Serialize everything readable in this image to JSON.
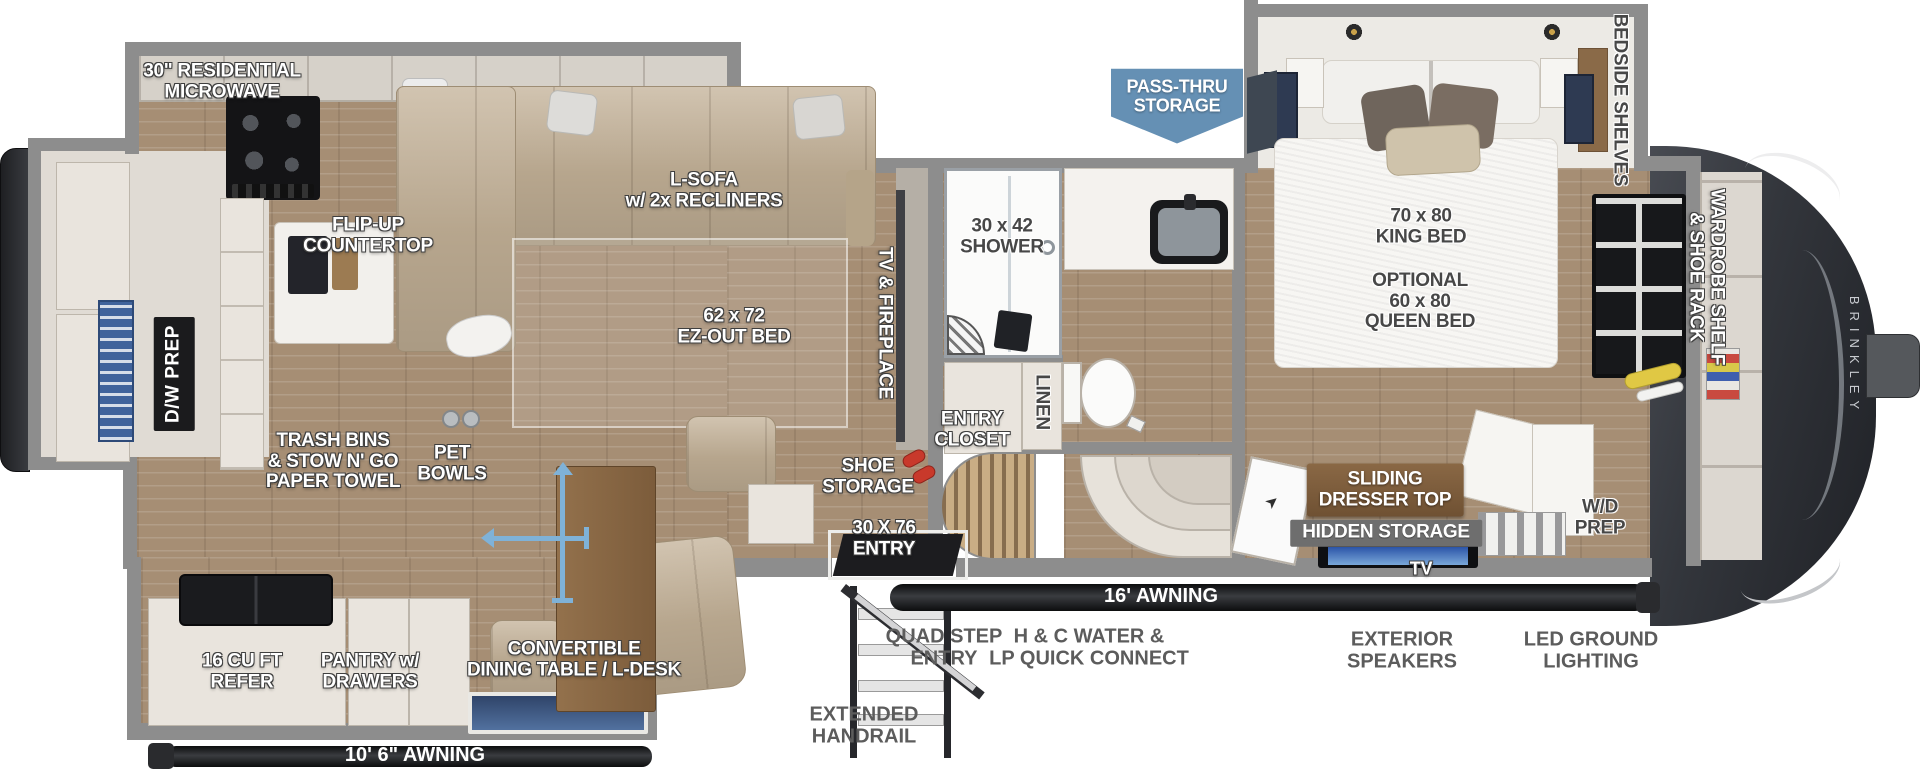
{
  "title": "Fifth wheel RV floor plan",
  "brand": "BRINKLEY",
  "colors": {
    "pass_thru_badge": "#6590b4",
    "move_arrows": "#7fb2d8",
    "awning_bar": "#1a1b1d",
    "tv_screen": "#2b54a8",
    "sign_wood": "#7b5a3a",
    "sign_gray": "#6e6e6e",
    "wall_gray": "#8d8d8d",
    "floor_wood": "#a68e74",
    "label_white": "#ffffff",
    "label_dark": "#474747"
  },
  "icons": {
    "door_arrow": "➤"
  },
  "labels": {
    "mw": {
      "text": "30\" RESIDENTIAL\nMICROWAVE"
    },
    "flip": {
      "text": "FLIP-UP\nCOUNTERTOP"
    },
    "sofa": {
      "text": "L-SOFA\nw/ 2x RECLINERS"
    },
    "ezbed": {
      "text": "62 x 72\nEZ-OUT BED"
    },
    "trash": {
      "text": "TRASH BINS\n& STOW N' GO\nPAPER TOWEL"
    },
    "pet": {
      "text": "PET\nBOWLS"
    },
    "tvfp": {
      "text": "TV & FIREPLACE"
    },
    "shower": {
      "text": "30 x 42\nSHOWER"
    },
    "closet": {
      "text": "ENTRY\nCLOSET"
    },
    "linen": {
      "text": "LINEN"
    },
    "shoe": {
      "text": "SHOE\nSTORAGE"
    },
    "entry": {
      "text": "30 X 76\nENTRY"
    },
    "king": {
      "text": "70 x 80\nKING BED"
    },
    "queen": {
      "text": "OPTIONAL\n60 x 80\nQUEEN BED"
    },
    "bedside": {
      "text": "BEDSIDE SHELVES"
    },
    "wardrobe": {
      "text": "WARDROBE SHELF\n& SHOE RACK"
    },
    "dresser": {
      "text": "SLIDING\nDRESSER TOP"
    },
    "hidden": {
      "text": "HIDDEN STORAGE"
    },
    "tv": {
      "text": "TV"
    },
    "wd": {
      "text": "W/D\nPREP"
    },
    "dw": {
      "text": "D/W PREP"
    },
    "refer": {
      "text": "16 CU FT\nREFER"
    },
    "pantry": {
      "text": "PANTRY w/\nDRAWERS"
    },
    "dinette": {
      "text": "CONVERTIBLE\nDINING TABLE / L-DESK"
    },
    "awn_l": {
      "text": "10' 6\" AWNING"
    },
    "awn_r": {
      "text": "16' AWNING"
    },
    "handrail": {
      "text": "EXTENDED\nHANDRAIL"
    },
    "quad": {
      "text": "QUAD STEP\nENTRY"
    },
    "hc": {
      "text": "H & C WATER &\nLP QUICK CONNECT"
    },
    "spk": {
      "text": "EXTERIOR\nSPEAKERS"
    },
    "led": {
      "text": "LED GROUND\nLIGHTING"
    },
    "pass": {
      "text": "PASS-THRU\nSTORAGE"
    }
  }
}
